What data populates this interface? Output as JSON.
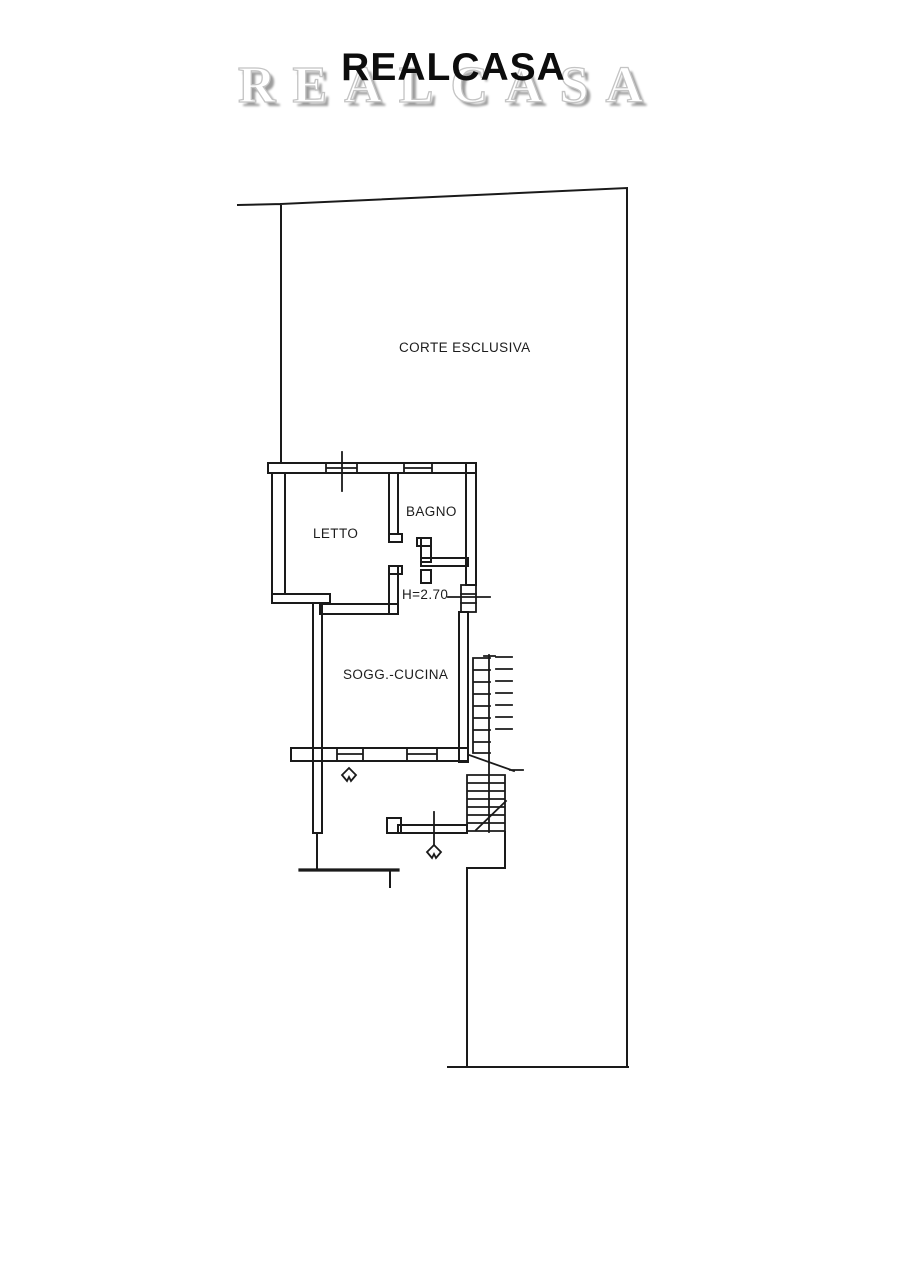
{
  "header": {
    "title": "REALCASA",
    "watermark": "REALCASA"
  },
  "floorplan": {
    "labels": {
      "courtyard": "CORTE ESCLUSIVA",
      "bedroom": "LETTO",
      "bathroom": "BAGNO",
      "ceiling_height": "H=2.70",
      "living_kitchen": "SOGG.-CUCINA"
    },
    "colors": {
      "line": "#1a1a1a",
      "paper": "#ffffff",
      "watermark_shadow": "#9d9d9d"
    }
  }
}
